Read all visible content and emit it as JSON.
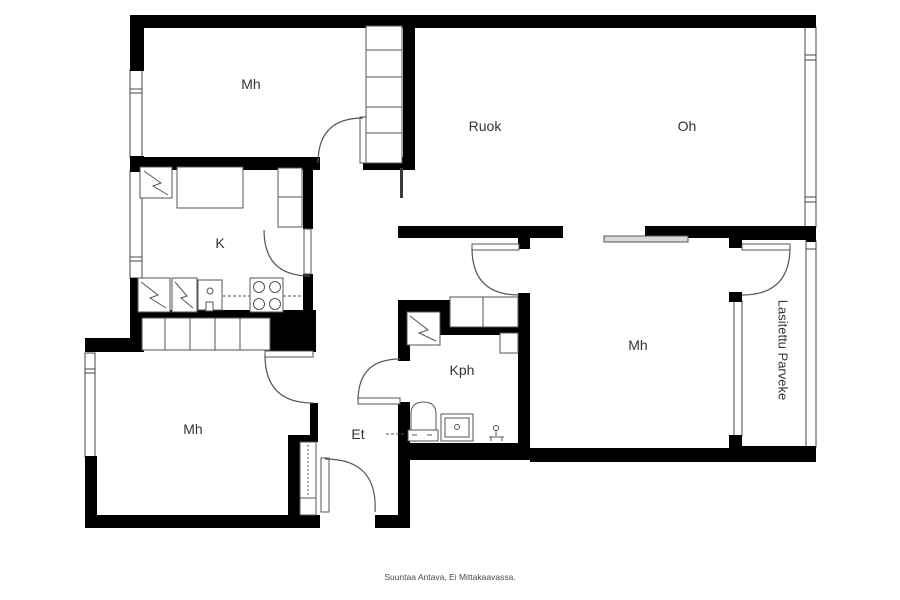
{
  "plan": {
    "rooms": {
      "mh_top": {
        "label": "Mh"
      },
      "ruok": {
        "label": "Ruok"
      },
      "oh": {
        "label": "Oh"
      },
      "k": {
        "label": "K"
      },
      "mh_left": {
        "label": "Mh"
      },
      "et": {
        "label": "Et"
      },
      "kph": {
        "label": "Kph"
      },
      "mh_right": {
        "label": "Mh"
      },
      "balcony": {
        "label": "Lasitettu Parveke"
      }
    },
    "caption": "Suuntaa Antava, Ei Mittakaavassa.",
    "colors": {
      "wall": "#000000",
      "line": "#444444",
      "furniture_line": "#555555",
      "label_text": "#333333",
      "background": "#ffffff"
    },
    "icons": {
      "fridge-icon": "zigzag-square",
      "freezer-icon": "zigzag-square",
      "washing-machine-icon": "zigzag-square",
      "stove-icon": "four-burners",
      "sink-icon": "basin-with-dot",
      "toilet-icon": "dome-with-base",
      "shower-icon": "tap-figure",
      "window-icon": "double-line",
      "door-icon": "quarter-arc"
    }
  }
}
